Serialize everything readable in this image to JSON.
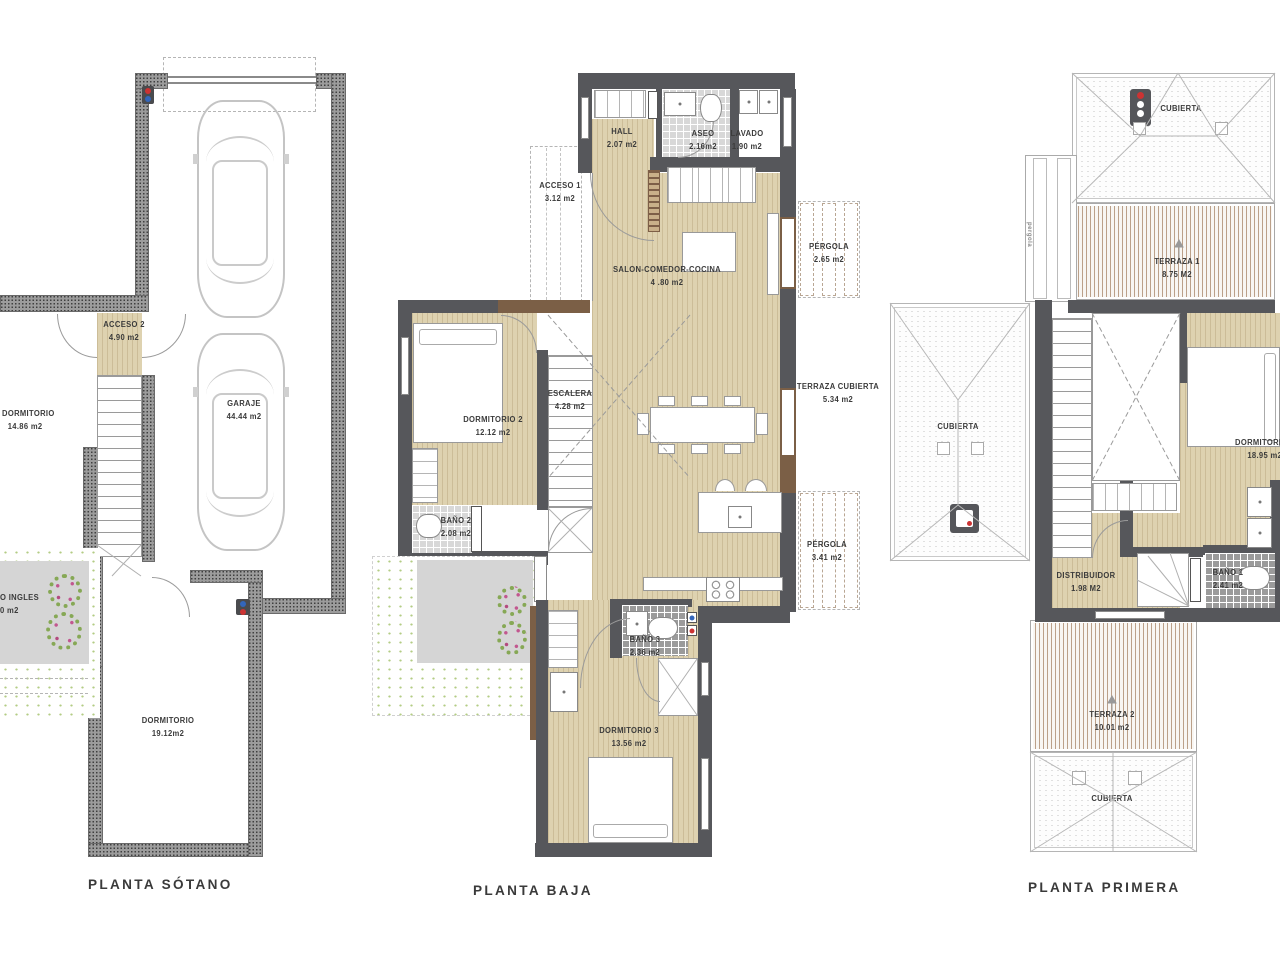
{
  "captions": {
    "sotano": "PLANTA SÓTANO",
    "baja": "PLANTA BAJA",
    "primera": "PLANTA PRIMERA"
  },
  "colors": {
    "wall_solid": "#56575b",
    "wall_hatched": "#9c9c9c",
    "floor_wood": "#ded2b0",
    "frame_brown": "#7b5f46",
    "tile_light": "#d8d8d8",
    "tile_dark": "#9b9b9b",
    "accent_red": "#cc3333",
    "accent_blue": "#3366bb",
    "grass_green": "#b3cc84",
    "patio_gray": "#d5d5d5"
  },
  "plans": {
    "sotano": {
      "rooms": {
        "dorm1": {
          "name": "DORMITORIO",
          "area": "14.86 m2"
        },
        "acceso2": {
          "name": "ACCESO 2",
          "area": "4.90 m2"
        },
        "garaje": {
          "name": "GARAJE",
          "area": "44.44 m2"
        },
        "patio": {
          "name": "O INGLES",
          "area": "0 m2"
        },
        "dorm2": {
          "name": "DORMITORIO",
          "area": "19.12m2"
        }
      }
    },
    "baja": {
      "rooms": {
        "hall": {
          "name": "HALL",
          "area": "2.07 m2"
        },
        "aseo": {
          "name": "ASEO",
          "area": "2.16m2"
        },
        "lavado": {
          "name": "LAVADO",
          "area": "1.90 m2"
        },
        "acceso1": {
          "name": "ACCESO 1",
          "area": "3.12 m2"
        },
        "salon": {
          "name": "SALON-COMEDOR-COCINA",
          "area": "4 .80 m2"
        },
        "dorm2": {
          "name": "DORMITORIO 2",
          "area": "12.12 m2"
        },
        "escalera": {
          "name": "ESCALERA",
          "area": "4.28 m2"
        },
        "bano2": {
          "name": "BAÑO 2",
          "area": "2.08 m2"
        },
        "pergola1": {
          "name": "PÉRGOLA",
          "area": "2.65 m2"
        },
        "terrazacub": {
          "name": "TERRAZA CUBIERTA",
          "area": "5.34 m2"
        },
        "pergola2": {
          "name": "PÉRGOLA",
          "area": "3.41 m2"
        },
        "bano3": {
          "name": "BAÑO 3",
          "area": "2.36 m2"
        },
        "dorm3": {
          "name": "DORMITORIO 3",
          "area": "13.56 m2"
        }
      }
    },
    "primera": {
      "rooms": {
        "cub_top": {
          "name": "CUBIERTA"
        },
        "terraza1": {
          "name": "TERRAZA 1",
          "area": "8.75 M2"
        },
        "pergola_v": {
          "name": "pergola"
        },
        "cub_left": {
          "name": "CUBIERTA"
        },
        "dorm": {
          "name": "DORMITORIO",
          "area": "18.95 m2"
        },
        "distribuidor": {
          "name": "DISTRIBUIDOR",
          "area": "1.98 M2"
        },
        "bano1": {
          "name": "BAÑO 1",
          "area": "2.41 m2"
        },
        "terraza2": {
          "name": "TERRAZA 2",
          "area": "10.01 m2"
        },
        "cub_bottom": {
          "name": "CUBIERTA"
        }
      }
    }
  }
}
